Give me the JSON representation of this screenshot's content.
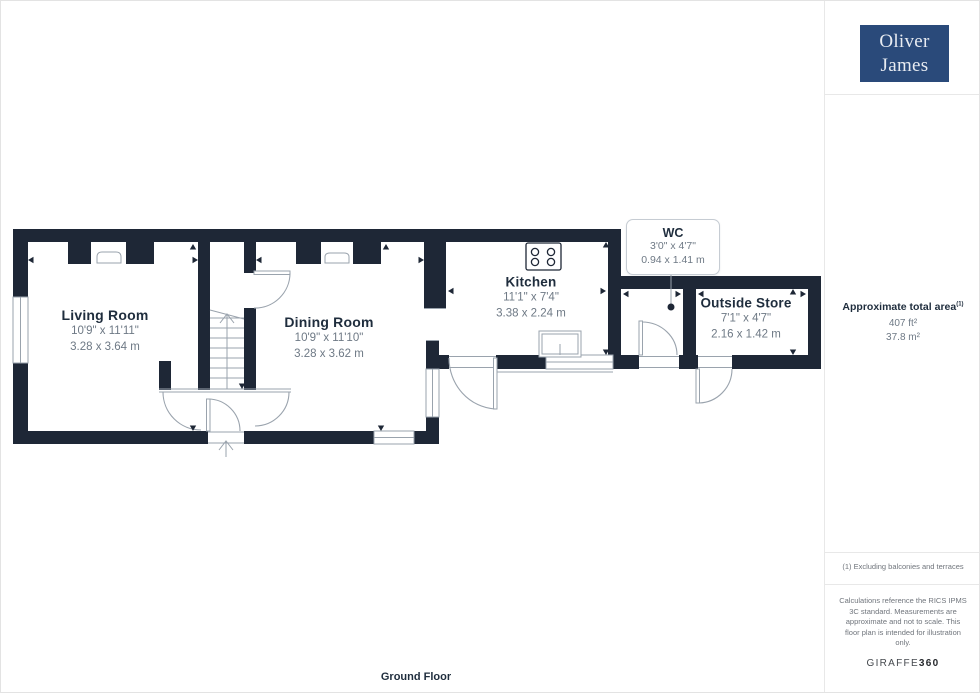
{
  "branding": {
    "logo_line1": "Oliver",
    "logo_line2": "James",
    "agency_colors": {
      "logo_bg": "#2a4a7a",
      "logo_text": "#e8ecf2"
    }
  },
  "sidebar": {
    "area_title": "Approximate total area",
    "area_title_sup": "(1)",
    "area_ft": "407 ft²",
    "area_m": "37.8 m²",
    "footnote": "(1) Excluding balconies and terraces",
    "disclaimer": "Calculations reference the RICS IPMS 3C standard. Measurements are approximate and not to scale. This floor plan is intended for illustration only.",
    "brand_name": "GIRAFFE",
    "brand_number": "360"
  },
  "floor": {
    "label": "Ground Floor"
  },
  "rooms": [
    {
      "name": "Living Room",
      "imperial": "10'9\" x 11'11\"",
      "metric": "3.28 x 3.64 m"
    },
    {
      "name": "Dining Room",
      "imperial": "10'9\" x 11'10\"",
      "metric": "3.28 x 3.62 m"
    },
    {
      "name": "Kitchen",
      "imperial": "11'1\" x 7'4\"",
      "metric": "3.38 x 2.24 m"
    },
    {
      "name": "WC",
      "imperial": "3'0\" x 4'7\"",
      "metric": "0.94 x 1.41 m"
    },
    {
      "name": "Outside Store",
      "imperial": "7'1\" x 4'7\"",
      "metric": "2.16 x 1.42 m"
    }
  ],
  "plan_colors": {
    "wall": "#1e2736",
    "symbol_line": "#9aa3ad",
    "title_text": "#1f2d3d",
    "dim_text": "#6e7985"
  }
}
